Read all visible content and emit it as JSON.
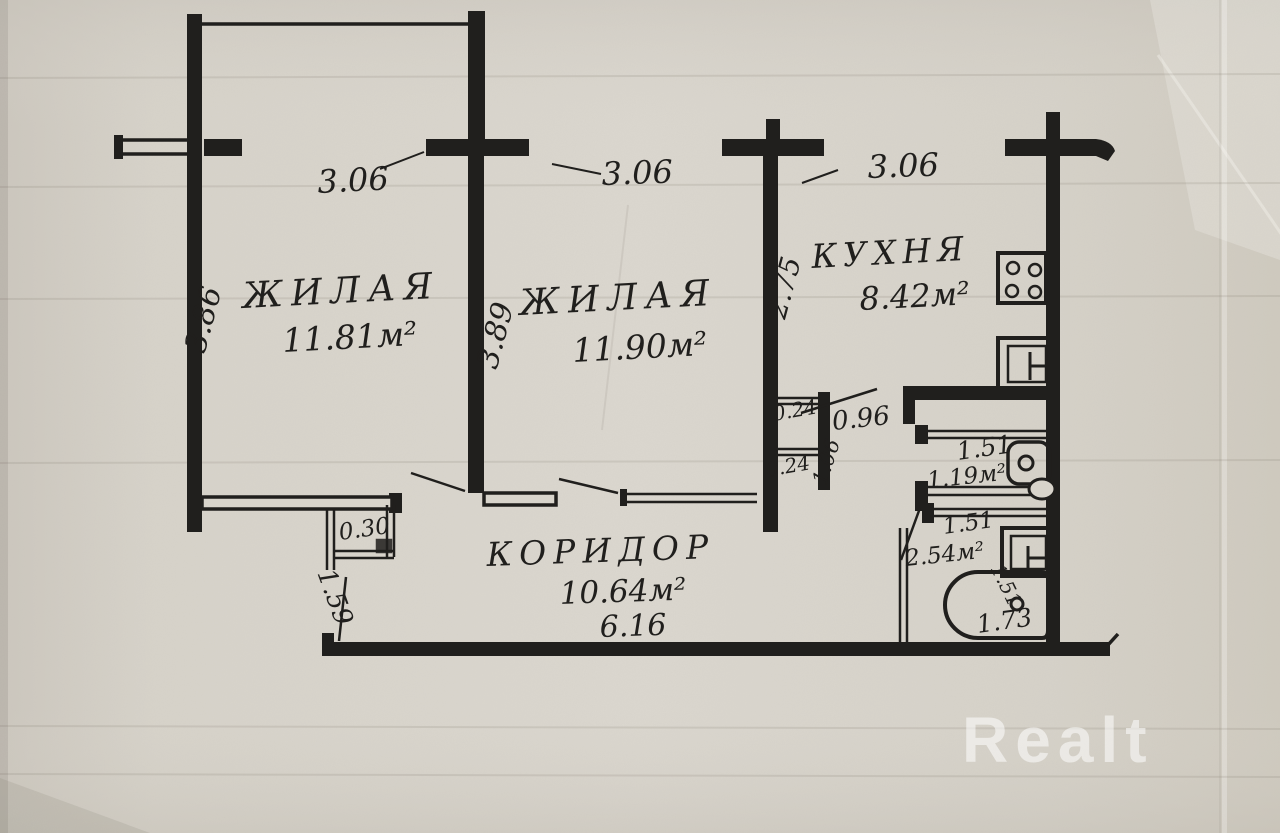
{
  "plan": {
    "room1": {
      "name": "ЖИЛАЯ",
      "area": "11.81м²",
      "width": "3.06",
      "depth": "3.86"
    },
    "room2": {
      "name": "ЖИЛАЯ",
      "area": "11.90м²",
      "width": "3.06",
      "depth": "3.89"
    },
    "kitchen": {
      "name": "КУХНЯ",
      "area": "8.42м²",
      "width": "3.06",
      "depth": "2.75"
    },
    "corridor": {
      "name": "КОРИДОР",
      "area": "10.64м²",
      "length": "6.16",
      "width": "1.59"
    },
    "wc": {
      "width": "1.51",
      "area": "1.19м²"
    },
    "bathroom": {
      "width": "1.51",
      "area": "2.54м²",
      "inner_dim": "1.51",
      "tub_length": "1.73"
    },
    "lobby": {
      "width": "0.96",
      "depth": "1.06",
      "wall_a": "0.24",
      "wall_b": "0.24"
    },
    "closet": {
      "depth": "0.30"
    }
  },
  "watermark": {
    "text": "Realt"
  },
  "colors": {
    "ink": "#201f1d",
    "paper": "#d8d4cb"
  }
}
